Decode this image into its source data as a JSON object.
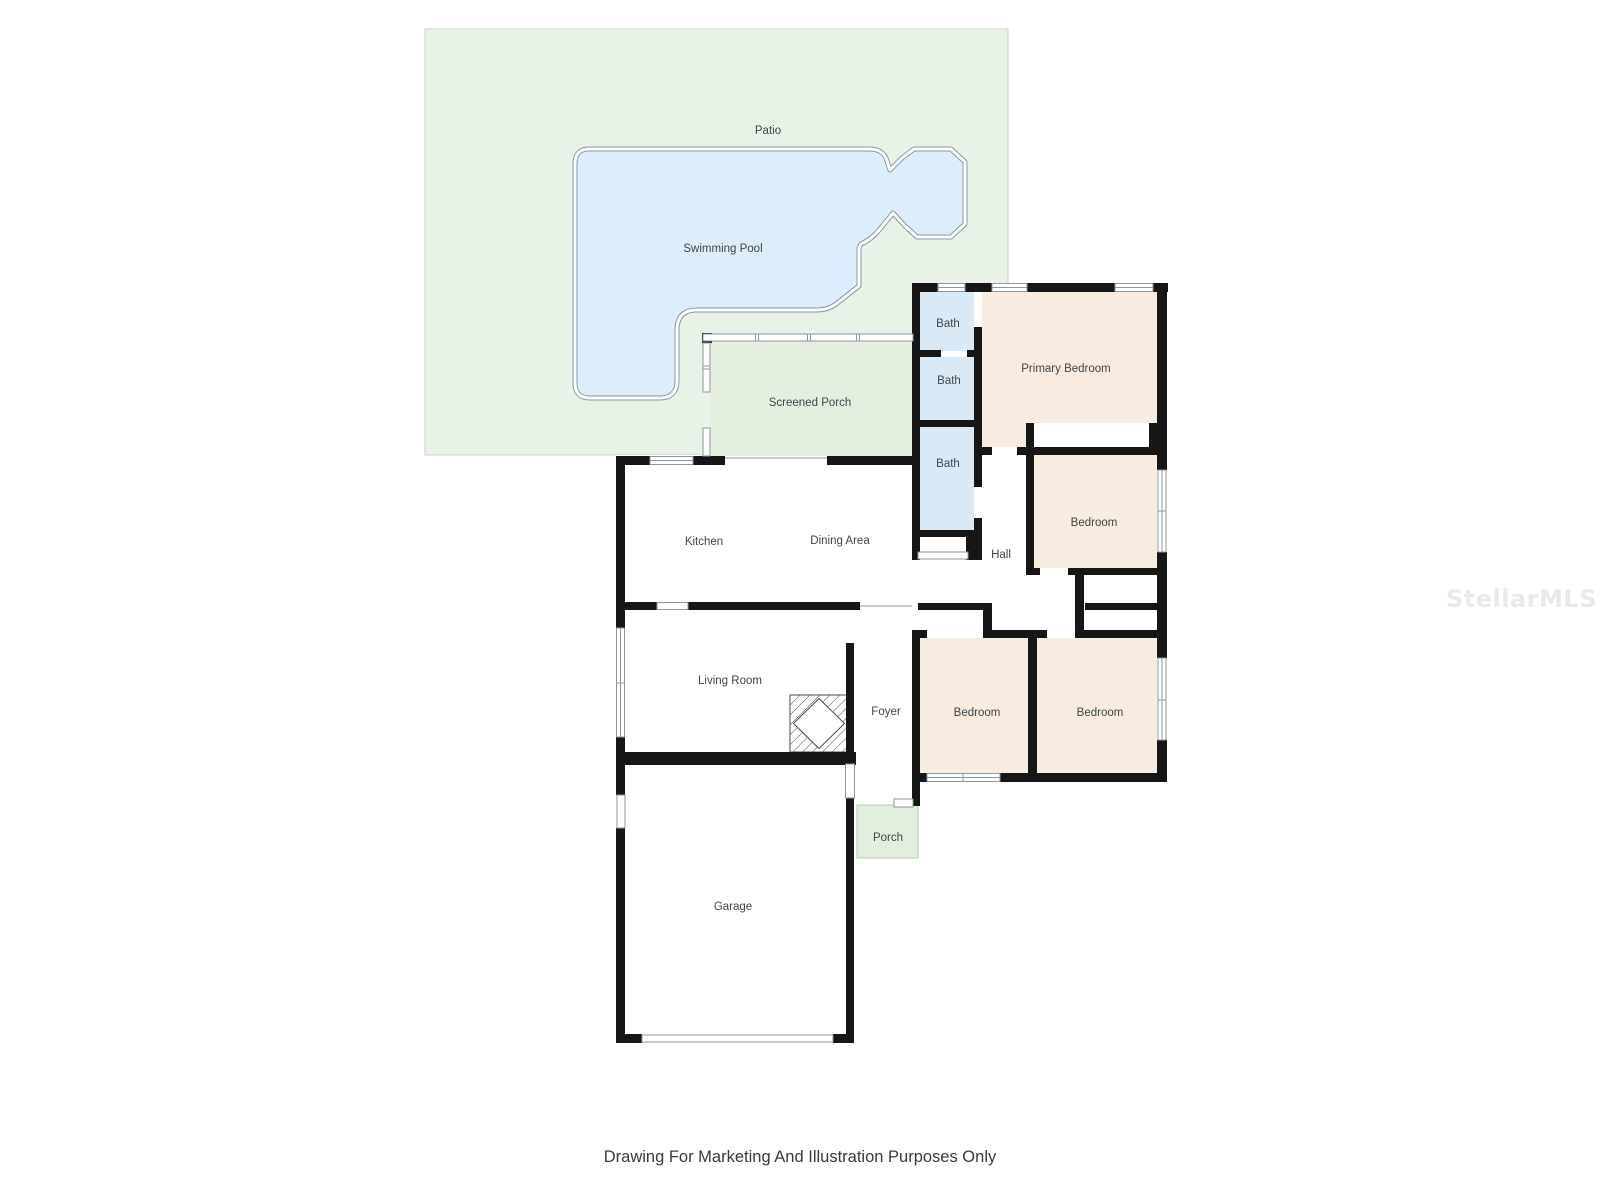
{
  "rooms": {
    "patio": {
      "label": "Patio"
    },
    "swimming_pool": {
      "label": "Swimming Pool"
    },
    "screened_porch": {
      "label": "Screened Porch"
    },
    "bath_1": {
      "label": "Bath"
    },
    "bath_2": {
      "label": "Bath"
    },
    "bath_3": {
      "label": "Bath"
    },
    "primary_bedroom": {
      "label": "Primary Bedroom"
    },
    "bedroom_2": {
      "label": "Bedroom"
    },
    "bedroom_3": {
      "label": "Bedroom"
    },
    "bedroom_4": {
      "label": "Bedroom"
    },
    "hall": {
      "label": "Hall"
    },
    "kitchen": {
      "label": "Kitchen"
    },
    "dining_area": {
      "label": "Dining Area"
    },
    "living_room": {
      "label": "Living Room"
    },
    "foyer": {
      "label": "Foyer"
    },
    "porch": {
      "label": "Porch"
    },
    "garage": {
      "label": "Garage"
    }
  },
  "footer": {
    "disclaimer": "Drawing For Marketing And Illustration Purposes Only"
  },
  "watermark": {
    "text": "StellarMLS"
  },
  "colors": {
    "background": "#ffffff",
    "wall": "#161616",
    "patio_fill": "#e8f2e7",
    "patio_border": "#c6d6c6",
    "screened_porch_fill": "#e5efdf",
    "porch_fill": "#e3efde",
    "pool_fill": "#deedfa",
    "pool_line": "#8797a3",
    "bath_fill": "#d9e9f6",
    "bedroom_fill": "#f7ecdf",
    "symbol_line": "#8d97a0",
    "label_text": "#3f4549",
    "disclaimer_text": "#3a3a3a",
    "watermark_text": "#e9e9ed"
  }
}
